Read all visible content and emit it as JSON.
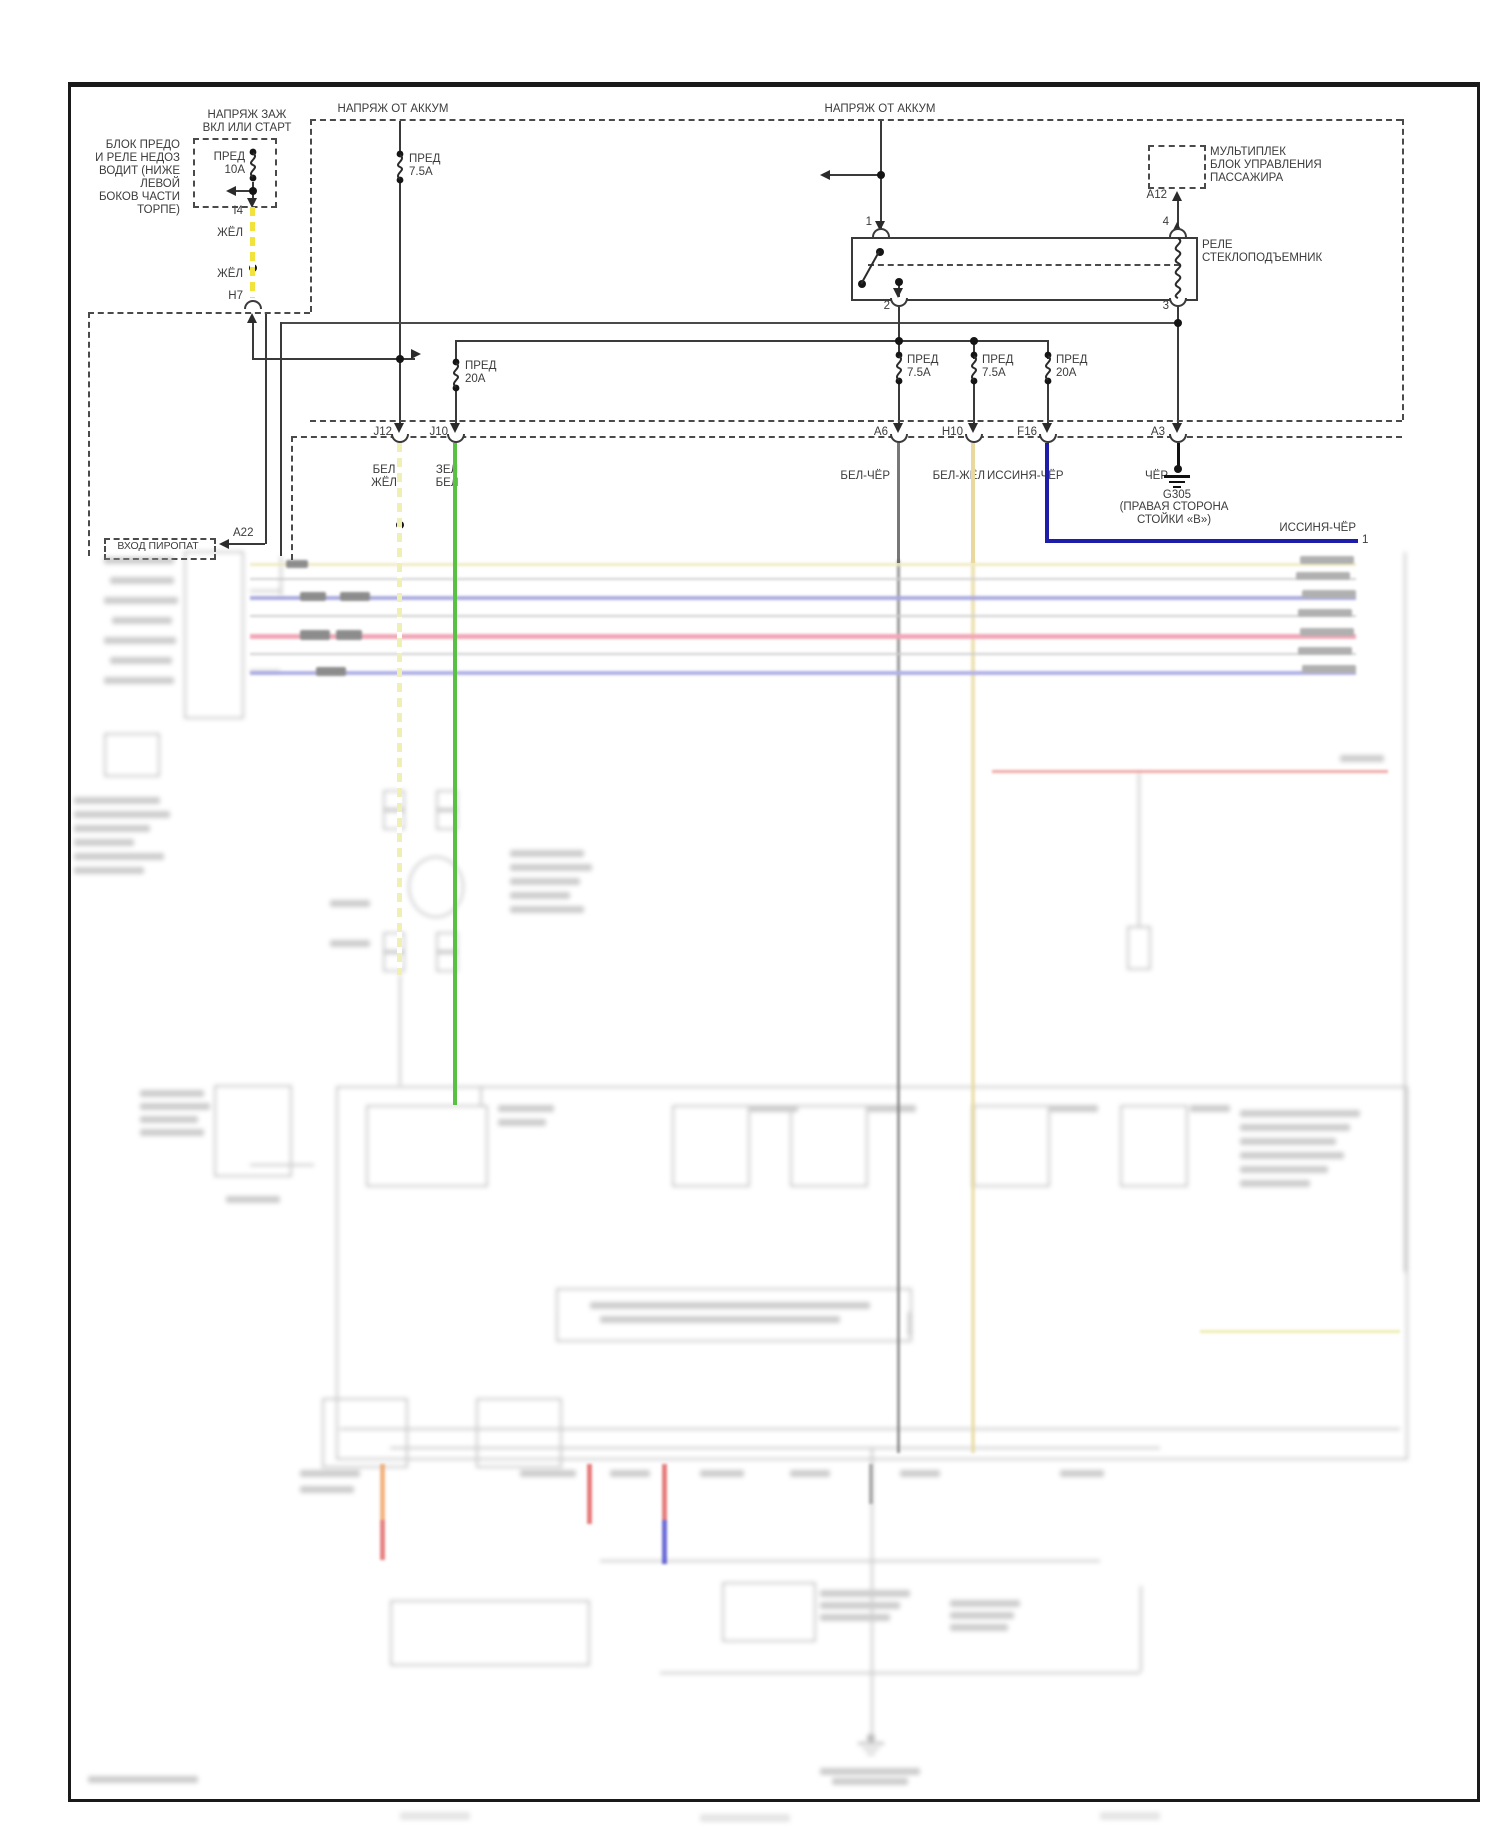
{
  "diagram": {
    "type": "wiring-diagram",
    "labels": {
      "ign": "НАПРЯЖ ЗАЖ\nВКЛ ИЛИ СТАРТ",
      "note": "БЛОК ПРЕДО\nИ РЕЛЕ НЕДОЗ\nВОДИТ (НИЖЕ\nЛЕВОЙ\nБОКОВ ЧАСТИ\nТОРПЕ)",
      "bat1": "НАПРЯЖ ОТ АККУМ",
      "bat2": "НАПРЯЖ ОТ АККУМ",
      "fuse10": "ПРЕД\n10А",
      "fuse75a": "ПРЕД\n7.5А",
      "i4": "I4",
      "zhel1": "ЖЁЛ",
      "zhel2": "ЖЁЛ",
      "h7": "H7",
      "mux": "МУЛЬТИПЛЕК\nБЛОК УПРАВЛЕНИЯ\nПАССАЖИРА",
      "a12": "A12",
      "relay": "РЕЛЕ\nСТЕКЛОПОДЪЕМНИК",
      "pin1": "1",
      "pin2": "2",
      "pin3": "3",
      "pin4": "4",
      "fuse20l": "ПРЕД\n20А",
      "fuse75b": "ПРЕД\n7.5А",
      "fuse75c": "ПРЕД\n7.5А",
      "fuse20r": "ПРЕД\n20А",
      "j12": "J12",
      "j10": "J10",
      "a6": "A6",
      "h10": "H10",
      "f16": "F16",
      "a3": "A3",
      "wj12": "БЕЛ\nЖЁЛ",
      "wj10": "ЗЕЛ\nБЕЛ",
      "wa6": "БЕЛ-ЧЁР",
      "wh10": "БЕЛ-ЖЁЛ",
      "wf16": "ИССИНЯ-ЧЁР",
      "wa3": "ЧЁР",
      "g305": "G305",
      "g305loc": "(ПРАВАЯ СТОРОНА\nСТОЙКИ «В»)",
      "blue_wire": "ИССИНЯ-ЧЁР",
      "blue_pin": "1",
      "piropat": "ВХОД ПИРОПАТ",
      "a22": "A22"
    },
    "wire_colors": {
      "yellow": "#f2e23c",
      "white_yellow_dashed": "#eef0b6",
      "green": "#58c143",
      "white_yellow_solid": "#e9d99e",
      "dark_blue": "#1d1daa",
      "black_wire": "#1a1a1a",
      "gray_wire": "#555555",
      "bus_blue": "#9292d8",
      "bus_red": "#ef8fa4",
      "line": "#3a3a3a"
    }
  }
}
